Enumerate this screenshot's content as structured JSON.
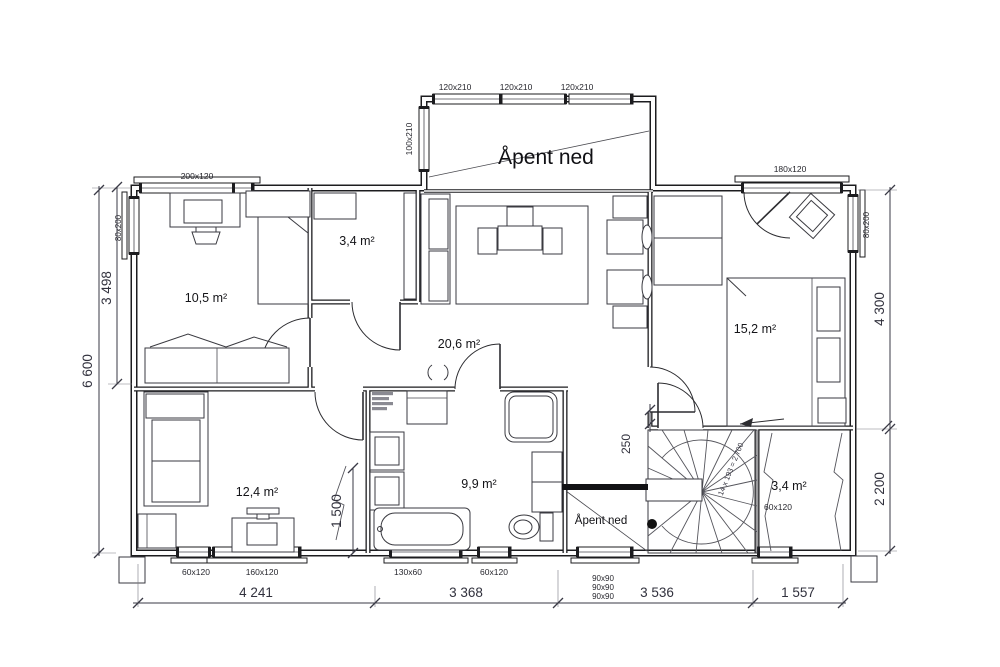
{
  "labels": {
    "open_above": "Åpent ned",
    "open_stair": "Åpent ned",
    "stair_calc": "14 x 193 = 2 700"
  },
  "rooms": [
    {
      "id": "office",
      "area": "10,5 m²"
    },
    {
      "id": "closet-top",
      "area": "3,4 m²"
    },
    {
      "id": "living-hall",
      "area": "20,6 m²"
    },
    {
      "id": "master-bedroom",
      "area": "15,2 m²"
    },
    {
      "id": "bedroom",
      "area": "12,4 m²"
    },
    {
      "id": "bathroom",
      "area": "9,9 m²"
    },
    {
      "id": "storage",
      "area": "3,4 m²"
    }
  ],
  "windows": {
    "top_left": "200x120",
    "dormer1": "120x210",
    "dormer2": "120x210",
    "dormer3": "120x210",
    "dormer_side": "100x210",
    "top_right": "180x120",
    "left_wall": "80x200",
    "right_wall": "80x200",
    "bottom1": "60x120",
    "bottom2": "160x120",
    "bottom3": "130x60",
    "bottom4": "60x120",
    "triple1": "90x90",
    "triple2": "90x90",
    "triple3": "90x90",
    "storage_win": "60x120"
  },
  "dimensions": {
    "left_total": "6 600",
    "left_part": "3 498",
    "right_top": "4 300",
    "right_bottom": "2 200",
    "jog": "250",
    "inner": "1 500",
    "bottom1": "4 241",
    "bottom2": "3 368",
    "bottom3": "3 536",
    "bottom4": "1 557"
  }
}
